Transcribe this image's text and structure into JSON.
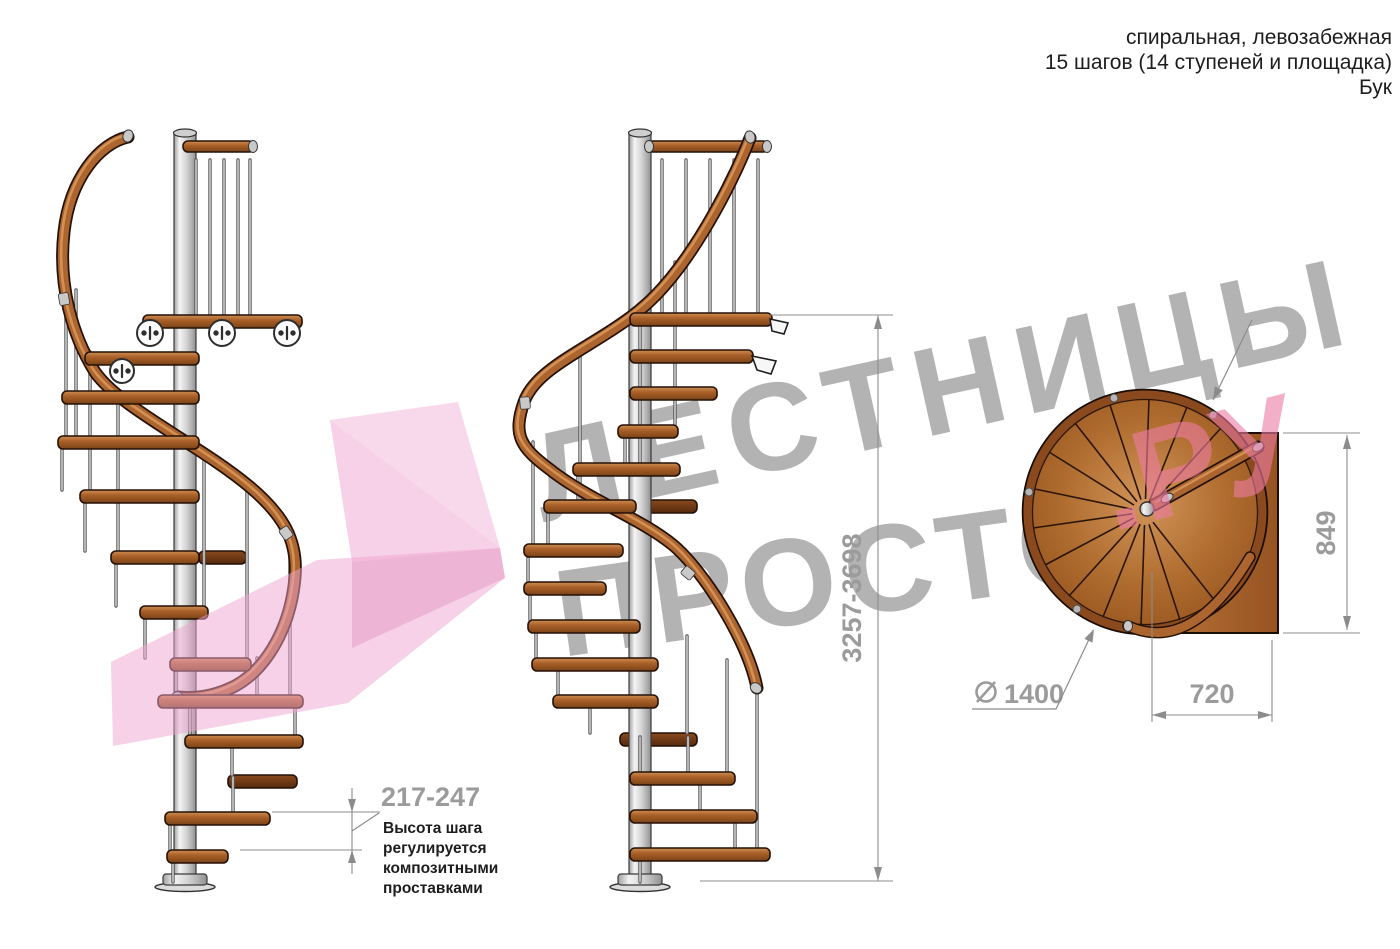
{
  "header": {
    "line1": "спиральная, левозабежная",
    "line2": "15 шагов (14 ступеней и площадка)",
    "line3": "Бук"
  },
  "watermark": {
    "word1": "ЛЕСТНИЦЫ",
    "word2": "ПРОСТО",
    "suffix": ".РУ"
  },
  "dimensions": {
    "total_height": "3257-3698",
    "step_height": "217-247",
    "note_line1": "Высота шага",
    "note_line2": "регулируется",
    "note_line3": "композитными",
    "note_line4": "проставками",
    "diameter": "1400",
    "landing_width": "720",
    "landing_depth": "849"
  },
  "colors": {
    "wood": "#aa6028",
    "wood_dark": "#6e3a16",
    "handrail": "#ad6530",
    "pole_gray": "#d6d6d6",
    "dim_gray": "#9b9b9b",
    "text_black": "#1d1d1d",
    "watermark_gray": "#a9a9a9",
    "watermark_pink": "#ee7ba4",
    "logo_pink": "#f0a3cf"
  }
}
